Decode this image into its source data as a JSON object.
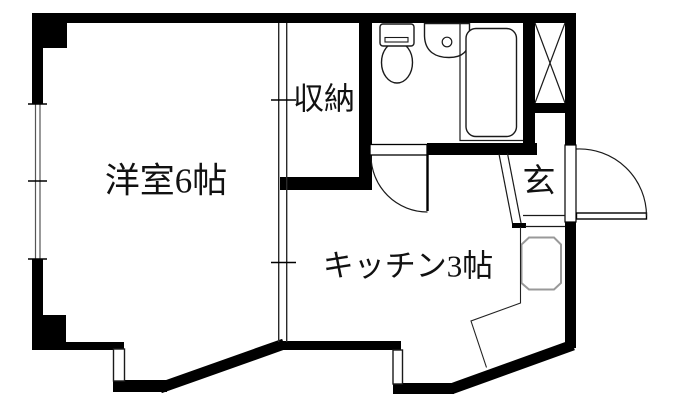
{
  "floor_plan": {
    "rooms": {
      "western_room_label": "洋室6帖",
      "kitchen_label": "キッチン3帖",
      "closet_label": "収納",
      "entrance_label": "玄"
    },
    "colors": {
      "wall": "#000000",
      "background": "#ffffff",
      "thin_line": "#1a1a1a",
      "window_line": "#555555",
      "fixture_gray": "#999999"
    }
  }
}
